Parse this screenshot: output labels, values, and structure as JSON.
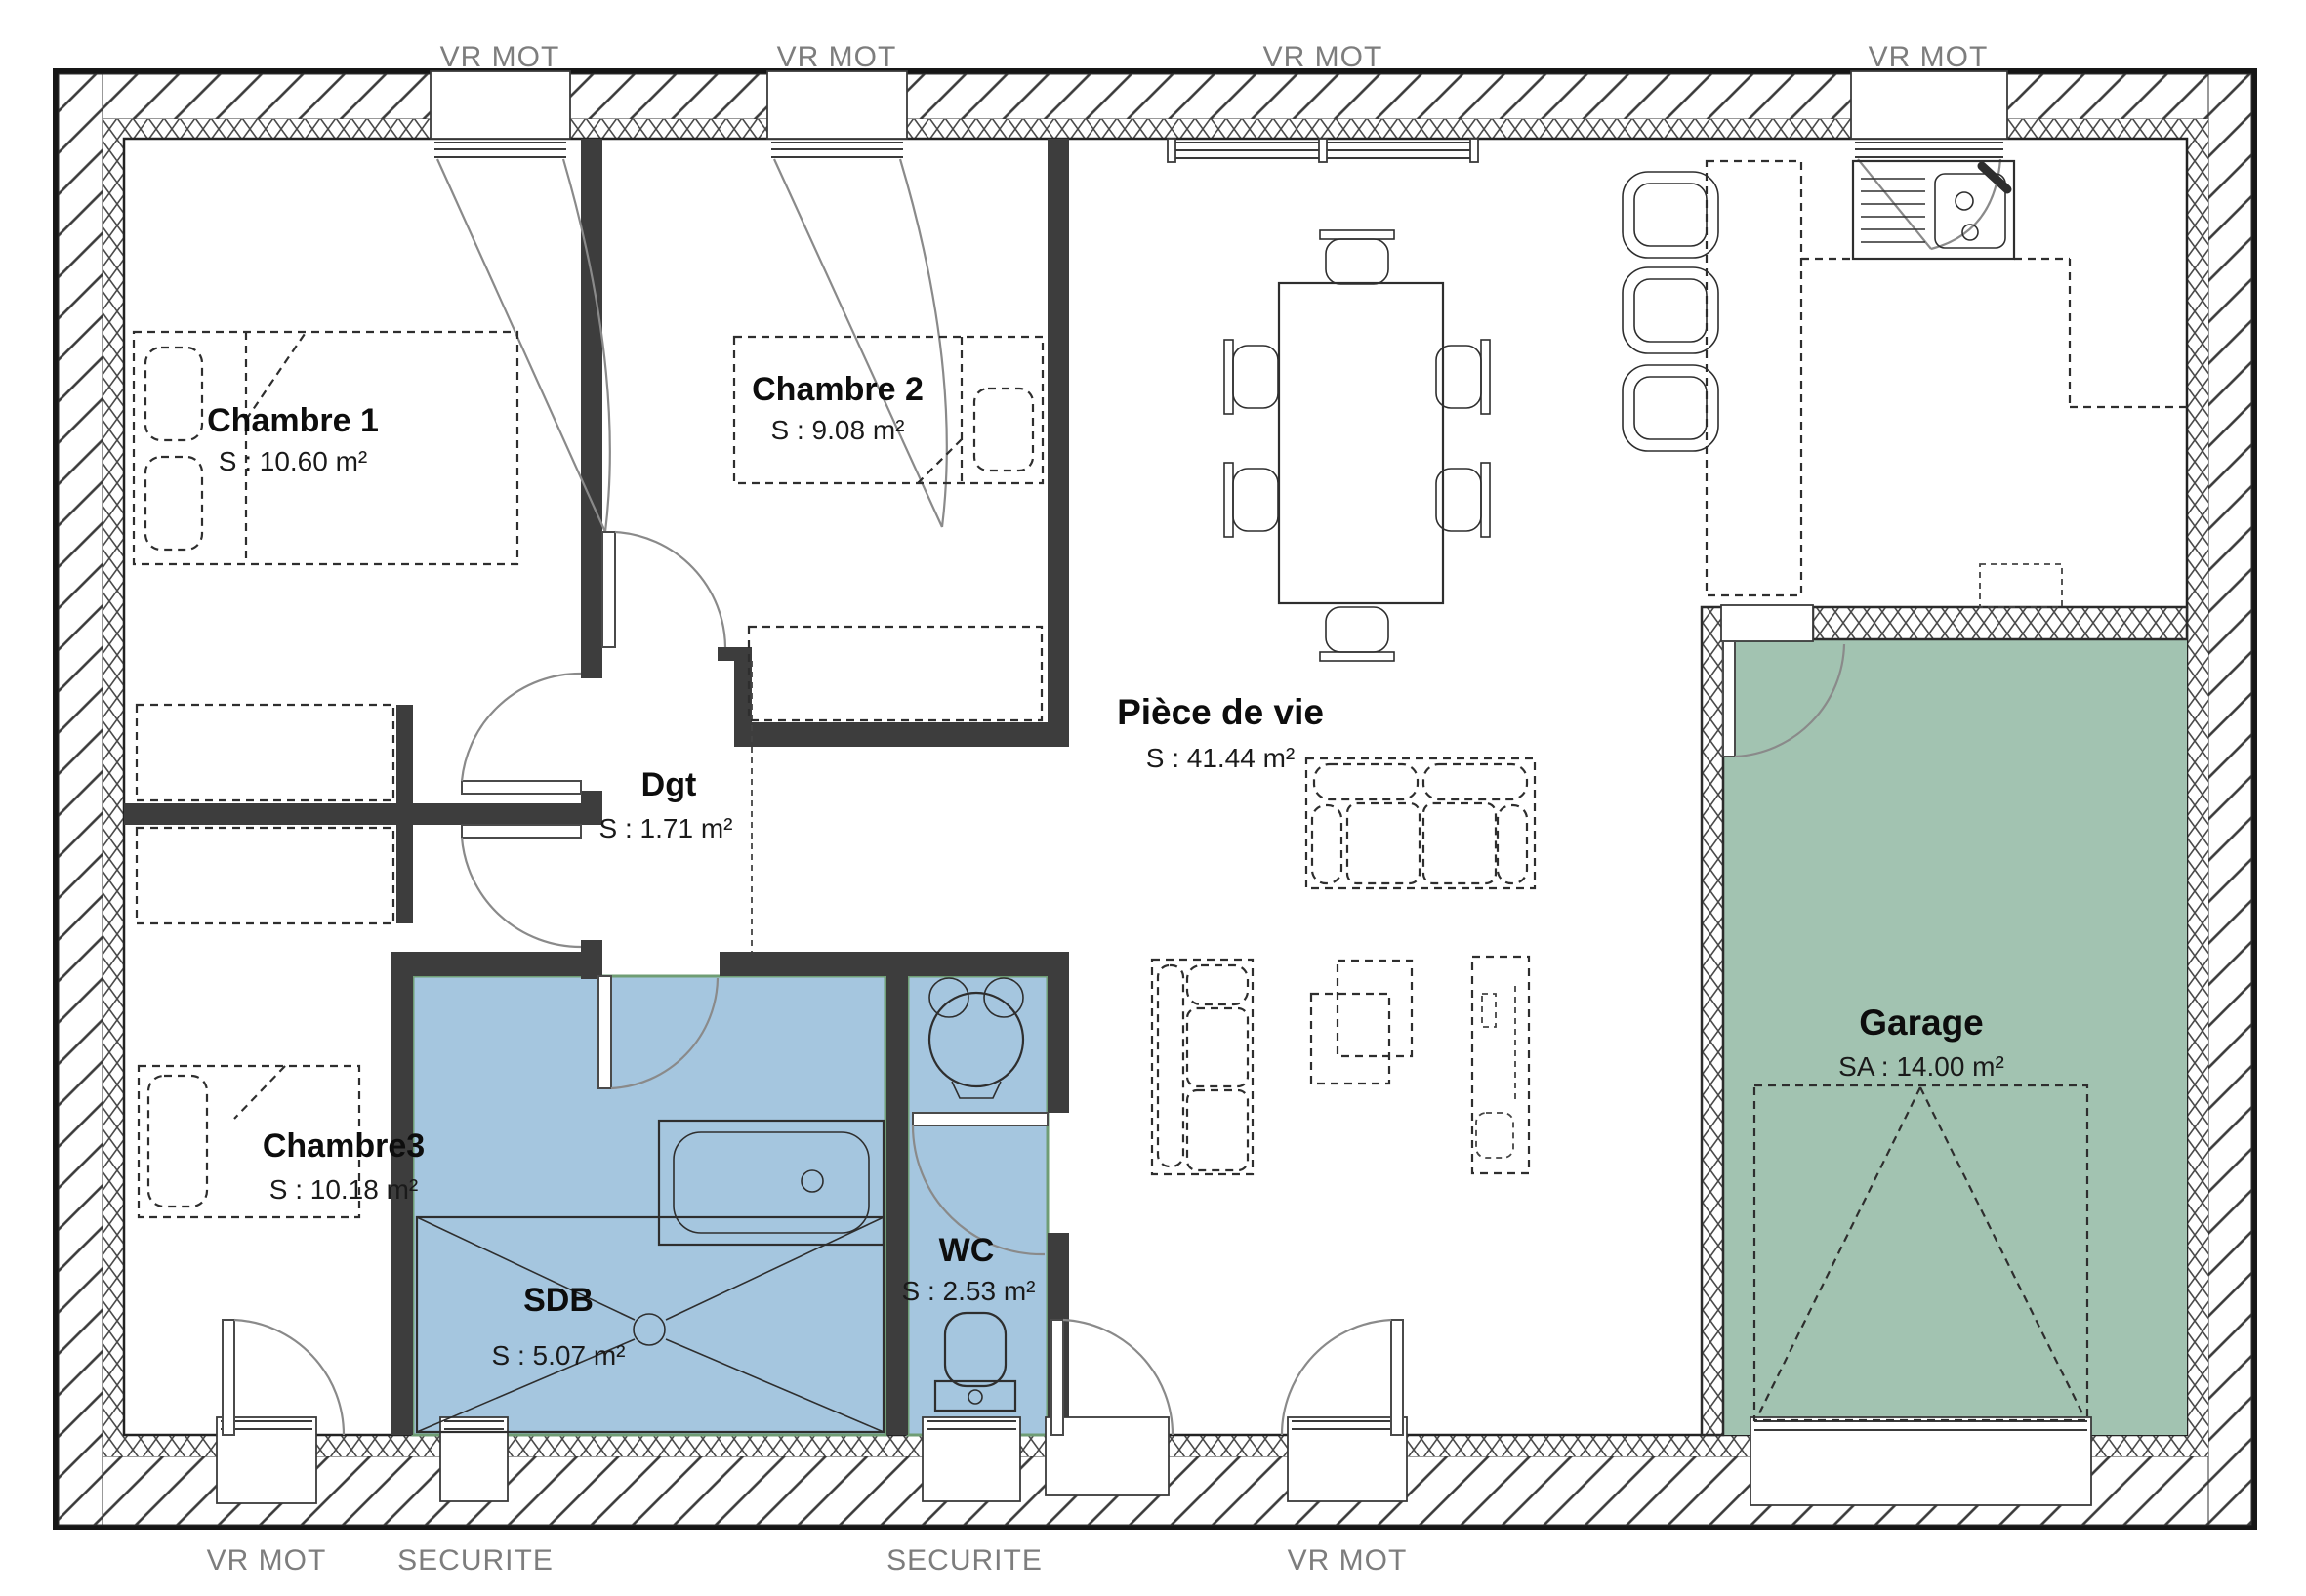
{
  "plan": {
    "title": "floor-plan",
    "rooms": [
      {
        "id": "chambre1",
        "name": "Chambre 1",
        "area": "S : 10.60 m²"
      },
      {
        "id": "chambre2",
        "name": "Chambre 2",
        "area": "S : 9.08 m²"
      },
      {
        "id": "chambre3",
        "name": "Chambre3",
        "area": "S : 10.18 m²"
      },
      {
        "id": "degagement",
        "name": "Dgt",
        "area": "S : 1.71 m²"
      },
      {
        "id": "piece-de-vie",
        "name": "Pièce de vie",
        "area": "S : 41.44 m²"
      },
      {
        "id": "sdb",
        "name": "SDB",
        "area": "S : 5.07 m²"
      },
      {
        "id": "wc",
        "name": "WC",
        "area": "S : 2.53 m²"
      },
      {
        "id": "garage",
        "name": "Garage",
        "area": "SA : 14.00 m²"
      }
    ],
    "window_labels": {
      "top": [
        "VR MOT",
        "VR MOT",
        "VR MOT",
        "VR MOT"
      ],
      "bottom": [
        "VR MOT",
        "SECURITE",
        "SECURITE",
        "VR MOT"
      ]
    },
    "colors": {
      "wet_room_blue": "#a5c6df",
      "wet_room_edge": "#6f9d74",
      "garage_green": "#a2c3b1",
      "wall_dark": "#3d3d3d",
      "label_gray": "#7d7d7d"
    }
  }
}
